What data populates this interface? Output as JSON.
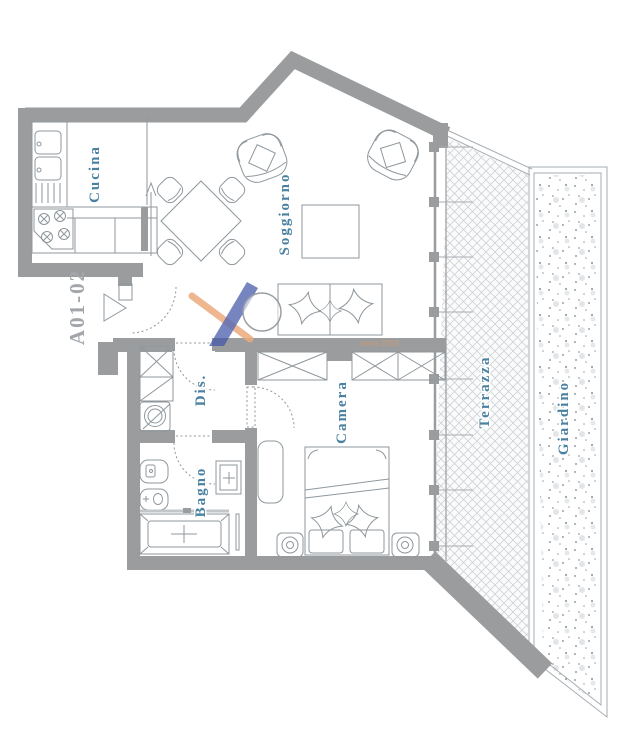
{
  "floor_plan": {
    "unit_label": "A01-02",
    "rooms": {
      "cucina": "Cucina",
      "soggiorno": "Soggiorno",
      "dis": "Dis.",
      "bagno": "Bagno",
      "camera": "Camera",
      "terrazza": "Terrazza",
      "giardino": "Giardino"
    },
    "watermark": {
      "since_text": "since 2003"
    },
    "colors": {
      "wall": "#9a9c9e",
      "room_label": "#4a81a0",
      "unit_label": "#a2a6aa",
      "logo_blue": "#4255a8",
      "logo_orange": "#ecab7d",
      "terrace_hatch": "#ced3d6",
      "garden_dots": "#9aa0a4"
    }
  }
}
